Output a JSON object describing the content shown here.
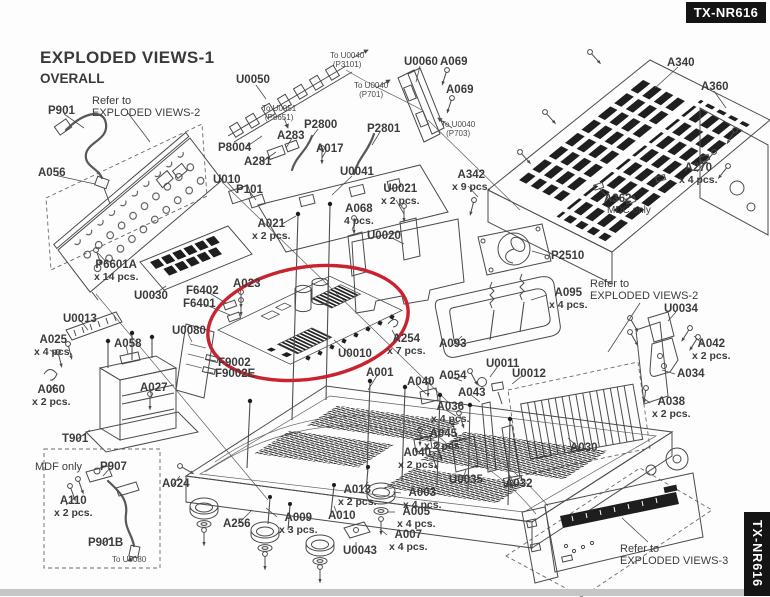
{
  "product": "TX-NR616",
  "badges": {
    "top": "TX-NR616",
    "side": "TX-NR616"
  },
  "title": {
    "line1": "EXPLODED VIEWS-1",
    "line2": "OVERALL"
  },
  "diagram": {
    "highlight_color": "#c8232e",
    "highlighted_part": "U0010",
    "labels": [
      {
        "t": [
          "To U0040",
          "(P3101)"
        ],
        "x": 330,
        "y": 52,
        "c": "small"
      },
      {
        "t": [
          "To U0040",
          "(P701)"
        ],
        "x": 354,
        "y": 82,
        "c": "small"
      },
      {
        "t": [
          "To U0051",
          "(P8651)"
        ],
        "x": 262,
        "y": 105,
        "c": "small"
      },
      {
        "t": [
          "To U0040",
          "(P703)"
        ],
        "x": 441,
        "y": 121,
        "c": "small"
      },
      {
        "t": [
          "To U0080"
        ],
        "x": 112,
        "y": 556,
        "c": "small"
      },
      {
        "t": [
          "Refer to",
          "EXPLODED VIEWS-2"
        ],
        "x": 92,
        "y": 95,
        "c": "note"
      },
      {
        "t": [
          "Refer to",
          "EXPLODED VIEWS-2"
        ],
        "x": 590,
        "y": 278,
        "c": "note"
      },
      {
        "t": [
          "Refer to",
          "EXPLODED VIEWS-3"
        ],
        "x": 620,
        "y": 543,
        "c": "note"
      },
      {
        "t": [
          "MDF only"
        ],
        "x": 35,
        "y": 461,
        "c": "note"
      },
      {
        "t": [
          "MDC only"
        ],
        "x": 607,
        "y": 205,
        "c": "note10"
      },
      {
        "t": [
          "P901"
        ],
        "x": 48,
        "y": 105,
        "c": "part"
      },
      {
        "t": [
          "A056"
        ],
        "x": 38,
        "y": 167,
        "c": "part"
      },
      {
        "t": [
          "U0050"
        ],
        "x": 236,
        "y": 74,
        "c": "part"
      },
      {
        "t": [
          "P8004"
        ],
        "x": 218,
        "y": 142,
        "c": "part"
      },
      {
        "t": [
          "A281"
        ],
        "x": 244,
        "y": 156,
        "c": "part"
      },
      {
        "t": [
          "A283"
        ],
        "x": 277,
        "y": 130,
        "c": "part"
      },
      {
        "t": [
          "P2800"
        ],
        "x": 304,
        "y": 119,
        "c": "part"
      },
      {
        "t": [
          "P2801"
        ],
        "x": 367,
        "y": 123,
        "c": "part"
      },
      {
        "t": [
          "A017"
        ],
        "x": 316,
        "y": 143,
        "c": "part"
      },
      {
        "t": [
          "U0041"
        ],
        "x": 340,
        "y": 166,
        "c": "part"
      },
      {
        "t": [
          "U010"
        ],
        "x": 213,
        "y": 174,
        "c": "part"
      },
      {
        "t": [
          "P101"
        ],
        "x": 236,
        "y": 184,
        "c": "part"
      },
      {
        "t": [
          "A021",
          "x 2 pcs."
        ],
        "x": 252,
        "y": 218,
        "c": "part"
      },
      {
        "t": [
          "U0060"
        ],
        "x": 404,
        "y": 56,
        "c": "part"
      },
      {
        "t": [
          "A069"
        ],
        "x": 440,
        "y": 56,
        "c": "part"
      },
      {
        "t": [
          "A069"
        ],
        "x": 446,
        "y": 84,
        "c": "part"
      },
      {
        "t": [
          "A340"
        ],
        "x": 667,
        "y": 57,
        "c": "part"
      },
      {
        "t": [
          "A360"
        ],
        "x": 701,
        "y": 81,
        "c": "part"
      },
      {
        "t": [
          "A270",
          "x 4 pcs."
        ],
        "x": 679,
        "y": 162,
        "c": "part"
      },
      {
        "t": [
          "A342",
          "x 9 pcs."
        ],
        "x": 452,
        "y": 169,
        "c": "part"
      },
      {
        "t": [
          "A362"
        ],
        "x": 604,
        "y": 193,
        "c": "part"
      },
      {
        "t": [
          "U0021",
          "x 2 pcs."
        ],
        "x": 381,
        "y": 183,
        "c": "part"
      },
      {
        "t": [
          "A068",
          "4 pcs."
        ],
        "x": 344,
        "y": 203,
        "c": "part"
      },
      {
        "t": [
          "U0020"
        ],
        "x": 367,
        "y": 230,
        "c": "part"
      },
      {
        "t": [
          "P6601A",
          "x 14 pcs."
        ],
        "x": 94,
        "y": 259,
        "c": "part"
      },
      {
        "t": [
          "U0030"
        ],
        "x": 134,
        "y": 290,
        "c": "part"
      },
      {
        "t": [
          "F6402"
        ],
        "x": 186,
        "y": 285,
        "c": "part"
      },
      {
        "t": [
          "F6401"
        ],
        "x": 183,
        "y": 298,
        "c": "part"
      },
      {
        "t": [
          "A023"
        ],
        "x": 233,
        "y": 278,
        "c": "part"
      },
      {
        "t": [
          "U0013"
        ],
        "x": 63,
        "y": 313,
        "c": "part"
      },
      {
        "t": [
          "A025",
          "x 4 pcs."
        ],
        "x": 34,
        "y": 334,
        "c": "part"
      },
      {
        "t": [
          "A058"
        ],
        "x": 114,
        "y": 338,
        "c": "part"
      },
      {
        "t": [
          "U0080"
        ],
        "x": 172,
        "y": 325,
        "c": "part"
      },
      {
        "t": [
          "F9002"
        ],
        "x": 218,
        "y": 357,
        "c": "part"
      },
      {
        "t": [
          "F9002E"
        ],
        "x": 215,
        "y": 368,
        "c": "part"
      },
      {
        "t": [
          "U0010"
        ],
        "x": 338,
        "y": 348,
        "c": "part"
      },
      {
        "t": [
          "A254",
          "x 7 pcs."
        ],
        "x": 387,
        "y": 333,
        "c": "part"
      },
      {
        "t": [
          "P2510"
        ],
        "x": 551,
        "y": 250,
        "c": "part"
      },
      {
        "t": [
          "A095",
          "x 4 pcs."
        ],
        "x": 549,
        "y": 287,
        "c": "part"
      },
      {
        "t": [
          "U0034"
        ],
        "x": 664,
        "y": 303,
        "c": "part"
      },
      {
        "t": [
          "A042",
          "x 2 pcs."
        ],
        "x": 692,
        "y": 338,
        "c": "part"
      },
      {
        "t": [
          "A034"
        ],
        "x": 677,
        "y": 368,
        "c": "part"
      },
      {
        "t": [
          "A093"
        ],
        "x": 439,
        "y": 338,
        "c": "part"
      },
      {
        "t": [
          "A060",
          "x 2 pcs."
        ],
        "x": 32,
        "y": 384,
        "c": "part"
      },
      {
        "t": [
          "A027"
        ],
        "x": 140,
        "y": 382,
        "c": "part"
      },
      {
        "t": [
          "T901"
        ],
        "x": 62,
        "y": 433,
        "c": "part"
      },
      {
        "t": [
          "P907"
        ],
        "x": 100,
        "y": 461,
        "c": "part"
      },
      {
        "t": [
          "A110",
          "x 2 pcs."
        ],
        "x": 54,
        "y": 495,
        "c": "part"
      },
      {
        "t": [
          "P901B"
        ],
        "x": 88,
        "y": 537,
        "c": "part"
      },
      {
        "t": [
          "A024"
        ],
        "x": 162,
        "y": 478,
        "c": "part"
      },
      {
        "t": [
          "A256"
        ],
        "x": 223,
        "y": 518,
        "c": "part"
      },
      {
        "t": [
          "A009",
          "x 3 pcs."
        ],
        "x": 279,
        "y": 512,
        "c": "part"
      },
      {
        "t": [
          "A010"
        ],
        "x": 328,
        "y": 510,
        "c": "part"
      },
      {
        "t": [
          "A013",
          "x 2 pcs."
        ],
        "x": 338,
        "y": 484,
        "c": "part"
      },
      {
        "t": [
          "U0043"
        ],
        "x": 343,
        "y": 545,
        "c": "part"
      },
      {
        "t": [
          "A003",
          "x 4 pcs."
        ],
        "x": 403,
        "y": 487,
        "c": "part"
      },
      {
        "t": [
          "A005",
          "x 4 pcs."
        ],
        "x": 397,
        "y": 506,
        "c": "part"
      },
      {
        "t": [
          "A007",
          "x 4 pcs."
        ],
        "x": 389,
        "y": 529,
        "c": "part"
      },
      {
        "t": [
          "A040"
        ],
        "x": 407,
        "y": 376,
        "c": "part"
      },
      {
        "t": [
          "A040",
          "x 2 pcs."
        ],
        "x": 398,
        "y": 447,
        "c": "part"
      },
      {
        "t": [
          "A054"
        ],
        "x": 439,
        "y": 370,
        "c": "part"
      },
      {
        "t": [
          "U0011"
        ],
        "x": 486,
        "y": 358,
        "c": "part"
      },
      {
        "t": [
          "U0012"
        ],
        "x": 512,
        "y": 368,
        "c": "part"
      },
      {
        "t": [
          "A043"
        ],
        "x": 458,
        "y": 387,
        "c": "part"
      },
      {
        "t": [
          "A036",
          "x 4 pcs."
        ],
        "x": 431,
        "y": 401,
        "c": "part"
      },
      {
        "t": [
          "A045",
          "x 2 pcs."
        ],
        "x": 424,
        "y": 428,
        "c": "part"
      },
      {
        "t": [
          "U0035"
        ],
        "x": 449,
        "y": 474,
        "c": "part"
      },
      {
        "t": [
          "A032"
        ],
        "x": 505,
        "y": 478,
        "c": "part"
      },
      {
        "t": [
          "A030"
        ],
        "x": 570,
        "y": 442,
        "c": "part"
      },
      {
        "t": [
          "A038",
          "x 2 pcs."
        ],
        "x": 652,
        "y": 396,
        "c": "part"
      },
      {
        "t": [
          "A001"
        ],
        "x": 366,
        "y": 367,
        "c": "part"
      }
    ]
  }
}
